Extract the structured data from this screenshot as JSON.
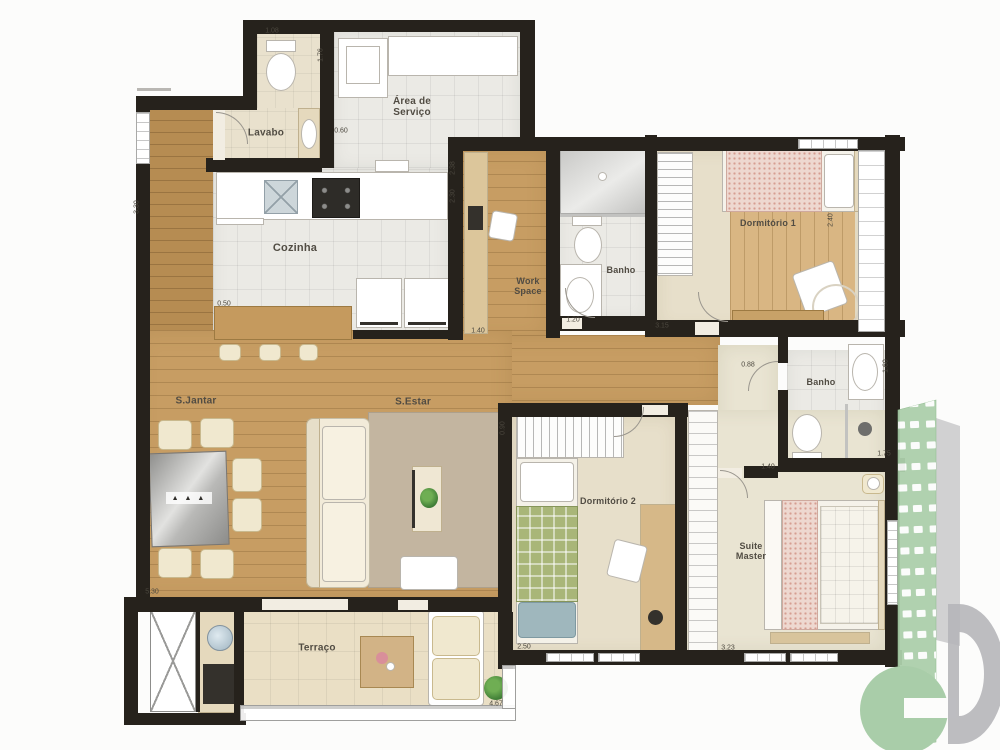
{
  "plan_title": "Apartment floor plan",
  "rooms": [
    {
      "id": "lavabo",
      "lines": [
        "Lavabo"
      ],
      "x": 266,
      "y": 133,
      "size": 10
    },
    {
      "id": "area-servico",
      "lines": [
        "Área de",
        "Serviço"
      ],
      "x": 412,
      "y": 107,
      "size": 10
    },
    {
      "id": "cozinha",
      "lines": [
        "Cozinha"
      ],
      "x": 295,
      "y": 248,
      "size": 11
    },
    {
      "id": "work-space",
      "lines": [
        "Work",
        "Space"
      ],
      "x": 528,
      "y": 286,
      "size": 9
    },
    {
      "id": "banho-social",
      "lines": [
        "Banho"
      ],
      "x": 621,
      "y": 270,
      "size": 9
    },
    {
      "id": "dormitorio-1",
      "lines": [
        "Dormitório 1"
      ],
      "x": 768,
      "y": 223,
      "size": 9
    },
    {
      "id": "s-jantar",
      "lines": [
        "S.Jantar"
      ],
      "x": 196,
      "y": 401,
      "size": 10
    },
    {
      "id": "s-estar",
      "lines": [
        "S.Estar"
      ],
      "x": 413,
      "y": 402,
      "size": 10
    },
    {
      "id": "dormitorio-2",
      "lines": [
        "Dormitório 2"
      ],
      "x": 608,
      "y": 501,
      "size": 9
    },
    {
      "id": "banho-suite",
      "lines": [
        "Banho"
      ],
      "x": 821,
      "y": 382,
      "size": 9
    },
    {
      "id": "suite-master",
      "lines": [
        "Suite",
        "Master"
      ],
      "x": 751,
      "y": 551,
      "size": 9
    },
    {
      "id": "terraco",
      "lines": [
        "Terraço"
      ],
      "x": 317,
      "y": 648,
      "size": 10
    }
  ],
  "dimensions": [
    {
      "t": "1.08",
      "x": 272,
      "y": 31
    },
    {
      "t": "1.76",
      "x": 321,
      "y": 55,
      "v": true
    },
    {
      "t": "0.60",
      "x": 341,
      "y": 131
    },
    {
      "t": "3.30",
      "x": 137,
      "y": 207,
      "v": true
    },
    {
      "t": "2.38",
      "x": 453,
      "y": 168,
      "v": true
    },
    {
      "t": "2.30",
      "x": 453,
      "y": 196,
      "v": true
    },
    {
      "t": "1.40",
      "x": 478,
      "y": 331
    },
    {
      "t": "1.20",
      "x": 573,
      "y": 320
    },
    {
      "t": "3.15",
      "x": 662,
      "y": 326
    },
    {
      "t": "2.40",
      "x": 831,
      "y": 220,
      "v": true
    },
    {
      "t": "0.88",
      "x": 748,
      "y": 365
    },
    {
      "t": "1.60",
      "x": 886,
      "y": 366,
      "v": true
    },
    {
      "t": "1.75",
      "x": 884,
      "y": 454
    },
    {
      "t": "1.40",
      "x": 768,
      "y": 467
    },
    {
      "t": "0.90",
      "x": 503,
      "y": 428,
      "v": true
    },
    {
      "t": "0.50",
      "x": 224,
      "y": 304
    },
    {
      "t": "5.30",
      "x": 152,
      "y": 592
    },
    {
      "t": "2.50",
      "x": 524,
      "y": 647
    },
    {
      "t": "3.23",
      "x": 728,
      "y": 648
    },
    {
      "t": "4.67",
      "x": 496,
      "y": 704
    }
  ],
  "colors": {
    "wall": "#26221c",
    "wood": "#c79d63",
    "woodDark": "#b68c52",
    "woodLight": "#d9b683",
    "tile": "#ebeae5",
    "carpet": "#e7dfca",
    "suiteCarpet": "#e9e4d2",
    "terrace": "#eadfc5",
    "furnBorder": "#b9b5ad",
    "plaidGreen": "#a9b678",
    "blanketPink": "#eed8d0",
    "rug": "#c3b5a0",
    "logoGreen": "#accfab",
    "logoGray": "#b2b2b7"
  },
  "watermark": {
    "name": "developer-building-logo"
  }
}
